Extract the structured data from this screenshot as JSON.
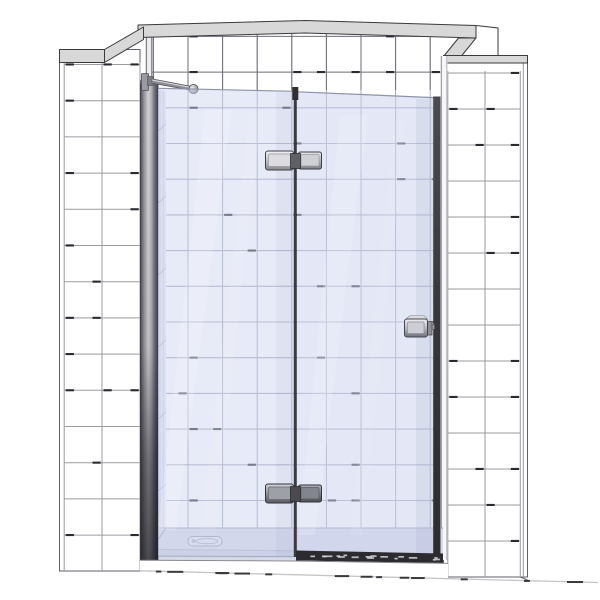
{
  "scene": {
    "type": "3d-product-render",
    "subject": "frameless hinged glass shower door with fixed side panel, mounted in a white tiled alcove over a low shower tray",
    "view": "front elevation with slight perspective",
    "components": [
      "back-tiled-wall",
      "left-tiled-wall",
      "right-tiled-wall",
      "wall-top-caps",
      "wall-mount-profile",
      "support-bar",
      "support-bar-knob",
      "fixed-glass-panel",
      "glass-door",
      "panel-hinge-top",
      "panel-hinge-bottom",
      "door-knob",
      "door-edge-profile",
      "door-bottom-seal",
      "shower-tray",
      "tray-drain",
      "floor-edge"
    ]
  },
  "colors": {
    "background": "#ffffff",
    "tile_white": "#ffffff",
    "grout_exterior": "#9b9ba0",
    "grout_interior": "#a6aabb",
    "grout_dark": "#6e6e76",
    "tick_mark": "#2a2a30",
    "wall_outline": "#60606a",
    "cap_fill": "#d8d8d8",
    "cap_outline": "#3a3a3f",
    "glass_tint": "#ccd4ee",
    "glass_edge": "#8d93a8",
    "frame_dark": "#323238",
    "metal_light": "#f0f0f3",
    "metal_mid": "#b4b4bc",
    "metal_dark": "#5f5f66",
    "metal_outline": "#42424a",
    "tray_fill": "#d7dae8",
    "tray_line": "#9aa0b5",
    "drain_fill": "#e4e6f0",
    "seal_dark": "#2b2b30",
    "seal_dash": "#d6d6db",
    "floor_line": "#c4c4c9",
    "floor_dash": "#3a3a3e",
    "reveal_fill": "#f7f7fa",
    "sliver_fill": "#e9ebf7"
  }
}
